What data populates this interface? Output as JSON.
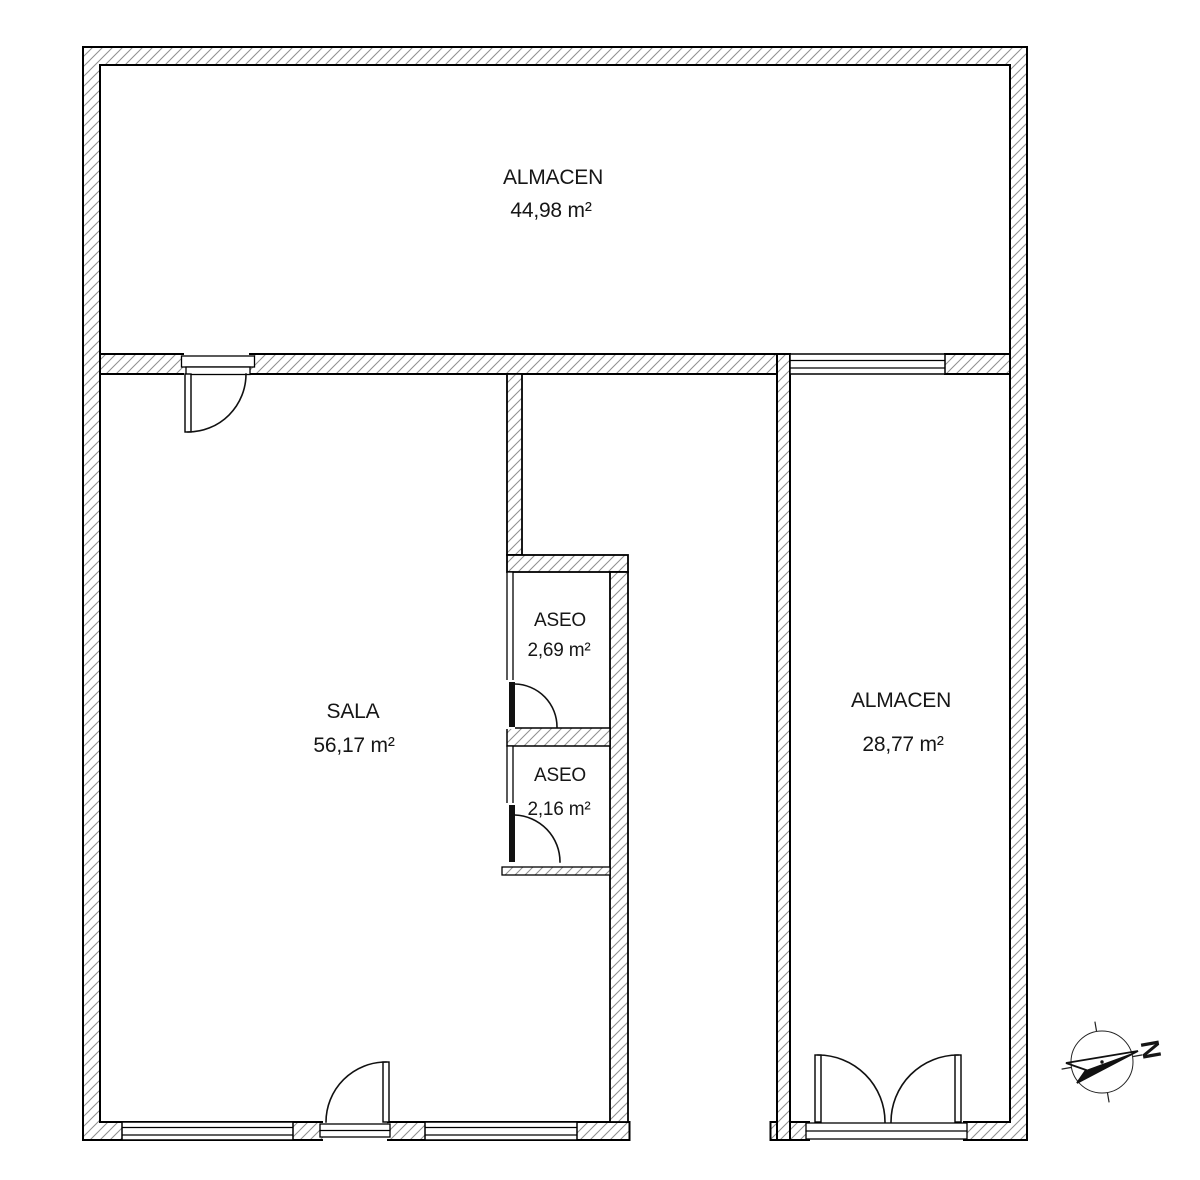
{
  "plan": {
    "rooms": [
      {
        "id": "almacen-top",
        "name": "ALMACEN",
        "area": "44,98 m²"
      },
      {
        "id": "sala",
        "name": "SALA",
        "area": "56,17 m²"
      },
      {
        "id": "aseo-1",
        "name": "ASEO",
        "area": "2,69 m²"
      },
      {
        "id": "aseo-2",
        "name": "ASEO",
        "area": "2,16 m²"
      },
      {
        "id": "almacen-right",
        "name": "ALMACEN",
        "area": "28,77 m²"
      }
    ],
    "compass": {
      "north_label": "N"
    },
    "colors": {
      "wall_hatch": "#8f8f8f",
      "line": "#000000",
      "text": "#161616",
      "background": "#ffffff"
    }
  }
}
